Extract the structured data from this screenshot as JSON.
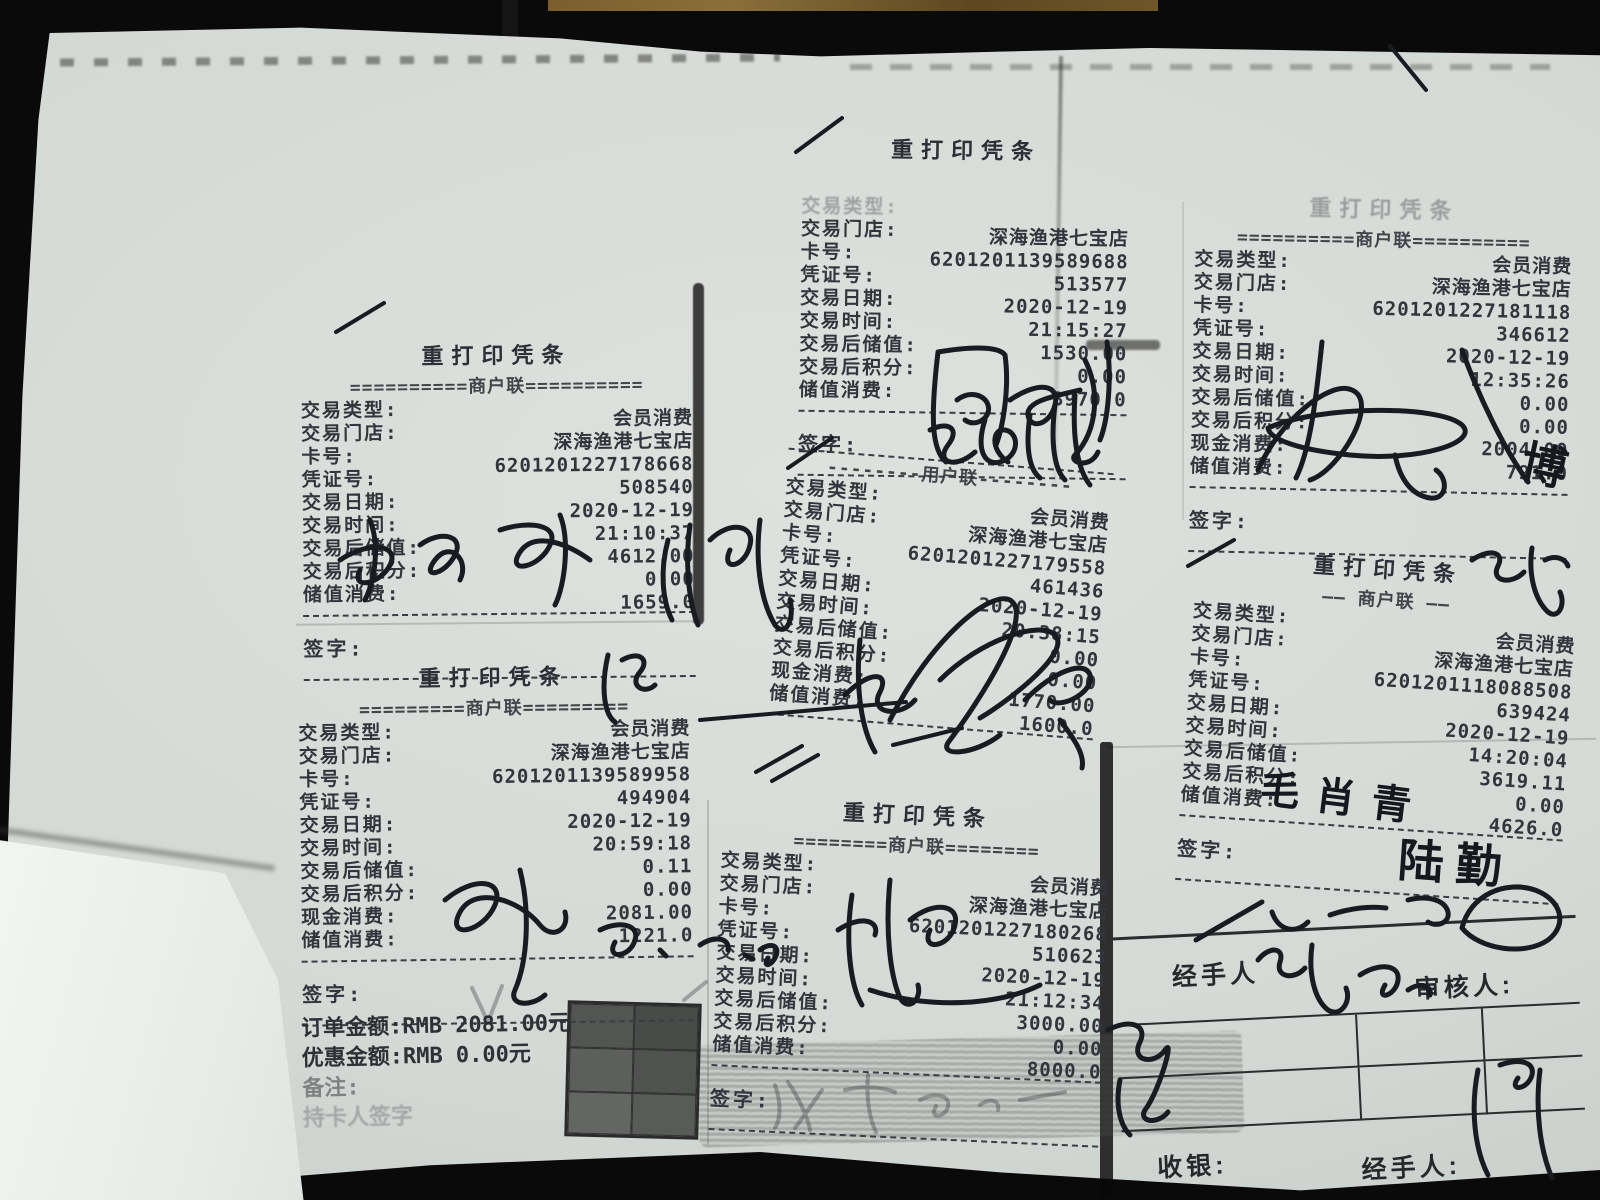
{
  "scene": {
    "background_color": "#0a0a0b",
    "paper_color": "#d8dbd7",
    "print_ink_color": "#32363c",
    "pen_ink_color": "#181b20",
    "wood_color": "#7a5f2d"
  },
  "receipts": [
    {
      "title": "重打印凭条",
      "copy": "==========商户联==========",
      "sign": "签字:",
      "rows": [
        {
          "label": "交易类型:",
          "value": "会员消费"
        },
        {
          "label": "交易门店:",
          "value": "深海渔港七宝店"
        },
        {
          "label": "卡号:",
          "value": "6201201227178668"
        },
        {
          "label": "凭证号:",
          "value": "508540"
        },
        {
          "label": "交易日期:",
          "value": "2020-12-19"
        },
        {
          "label": "交易时间:",
          "value": "21:10:37"
        },
        {
          "label": "交易后储值:",
          "value": "4612.00"
        },
        {
          "label": "交易后积分:",
          "value": "0.00"
        },
        {
          "label": "储值消费:",
          "value": "1659.0"
        }
      ]
    },
    {
      "title": "重打印凭条",
      "copy": "=========商户联=========",
      "sign": "签字:",
      "rows": [
        {
          "label": "交易类型:",
          "value": "会员消费"
        },
        {
          "label": "交易门店:",
          "value": "深海渔港七宝店"
        },
        {
          "label": "卡号:",
          "value": "6201201139589958"
        },
        {
          "label": "凭证号:",
          "value": "494904"
        },
        {
          "label": "交易日期:",
          "value": "2020-12-19"
        },
        {
          "label": "交易时间:",
          "value": "20:59:18"
        },
        {
          "label": "交易后储值:",
          "value": "0.11"
        },
        {
          "label": "交易后积分:",
          "value": "0.00"
        },
        {
          "label": "现金消费:",
          "value": "2081.00"
        },
        {
          "label": "储值消费:",
          "value": "1221.0"
        }
      ]
    },
    {
      "title": "重打印凭条",
      "copy": "",
      "sign": "签字:",
      "rows": [
        {
          "label": "交易类型:",
          "value": "",
          "faded": true
        },
        {
          "label": "交易门店:",
          "value": "深海渔港七宝店"
        },
        {
          "label": "卡号:",
          "value": "6201201139589688"
        },
        {
          "label": "凭证号:",
          "value": "513577"
        },
        {
          "label": "交易日期:",
          "value": "2020-12-19"
        },
        {
          "label": "交易时间:",
          "value": "21:15:27"
        },
        {
          "label": "交易后储值:",
          "value": "1530.00"
        },
        {
          "label": "交易后积分:",
          "value": "0.00"
        },
        {
          "label": "储值消费:",
          "value": "3970.0"
        }
      ]
    },
    {
      "title": "",
      "copy": "--------用户联--------",
      "sign": "",
      "top_div": true,
      "rows": [
        {
          "label": "交易类型:",
          "value": "会员消费"
        },
        {
          "label": "交易门店:",
          "value": "深海渔港七宝店"
        },
        {
          "label": "卡号:",
          "value": "6201201227179558"
        },
        {
          "label": "凭证号:",
          "value": "461436"
        },
        {
          "label": "交易日期:",
          "value": "2020-12-19"
        },
        {
          "label": "交易时间:",
          "value": "20:38:15"
        },
        {
          "label": "交易后储值:",
          "value": "0.00"
        },
        {
          "label": "交易后积分:",
          "value": "0.00"
        },
        {
          "label": "现金消费:",
          "value": "1770.00"
        },
        {
          "label": "储值消费:",
          "value": "1600.0"
        }
      ]
    },
    {
      "title": "重打印凭条",
      "copy": "========商户联========",
      "sign": "签字:",
      "rows": [
        {
          "label": "交易类型:",
          "value": "会员消费"
        },
        {
          "label": "交易门店:",
          "value": "深海渔港七宝店"
        },
        {
          "label": "卡号:",
          "value": "6201201227180268"
        },
        {
          "label": "凭证号:",
          "value": "510623"
        },
        {
          "label": "交易日期:",
          "value": "2020-12-19"
        },
        {
          "label": "交易时间:",
          "value": "21:12:34"
        },
        {
          "label": "交易后储值:",
          "value": "3000.00"
        },
        {
          "label": "交易后积分:",
          "value": "0.00"
        },
        {
          "label": "储值消费:",
          "value": "8000.0"
        }
      ]
    },
    {
      "title": "重打印凭条",
      "title_faded": true,
      "copy": "==========商户联==========",
      "sign": "签字:",
      "rows": [
        {
          "label": "交易类型:",
          "value": "会员消费"
        },
        {
          "label": "交易门店:",
          "value": "深海渔港七宝店"
        },
        {
          "label": "卡号:",
          "value": "6201201227181118"
        },
        {
          "label": "凭证号:",
          "value": "346612"
        },
        {
          "label": "交易日期:",
          "value": "2020-12-19"
        },
        {
          "label": "交易时间:",
          "value": "12:35:26"
        },
        {
          "label": "交易后储值:",
          "value": "0.00"
        },
        {
          "label": "交易后积分:",
          "value": "0.00"
        },
        {
          "label": "现金消费:",
          "value": "2004.00"
        },
        {
          "label": "储值消费:",
          "value": "791.0"
        }
      ]
    },
    {
      "title": "重打印凭条",
      "copy": "—— 商户联 ——",
      "sign": "签字:",
      "rows": [
        {
          "label": "交易类型:",
          "value": "会员消费"
        },
        {
          "label": "交易门店:",
          "value": "深海渔港七宝店"
        },
        {
          "label": "卡号:",
          "value": "6201201118088508"
        },
        {
          "label": "凭证号:",
          "value": "639424"
        },
        {
          "label": "交易日期:",
          "value": "2020-12-19"
        },
        {
          "label": "交易时间:",
          "value": "14:20:04"
        },
        {
          "label": "交易后储值:",
          "value": "3619.11"
        },
        {
          "label": "交易后积分:",
          "value": "0.00"
        },
        {
          "label": "储值消费:",
          "value": "4626.0"
        }
      ]
    }
  ],
  "order_summary": {
    "line1": "订单金额:RMB 2081.00元",
    "line2": "优惠金额:RMB 0.00元",
    "line3": "备注:",
    "line4": "持卡人签字"
  },
  "approval_table": {
    "handler_top_label": "经手人",
    "auditor_label": "审核人:",
    "cashier_label": "收银:",
    "handler_bottom_label": "经手人:"
  },
  "handwriting": {
    "signature_right_mid": "毛肖青",
    "signature_lu": "陆勤",
    "signature_bo": "博"
  }
}
